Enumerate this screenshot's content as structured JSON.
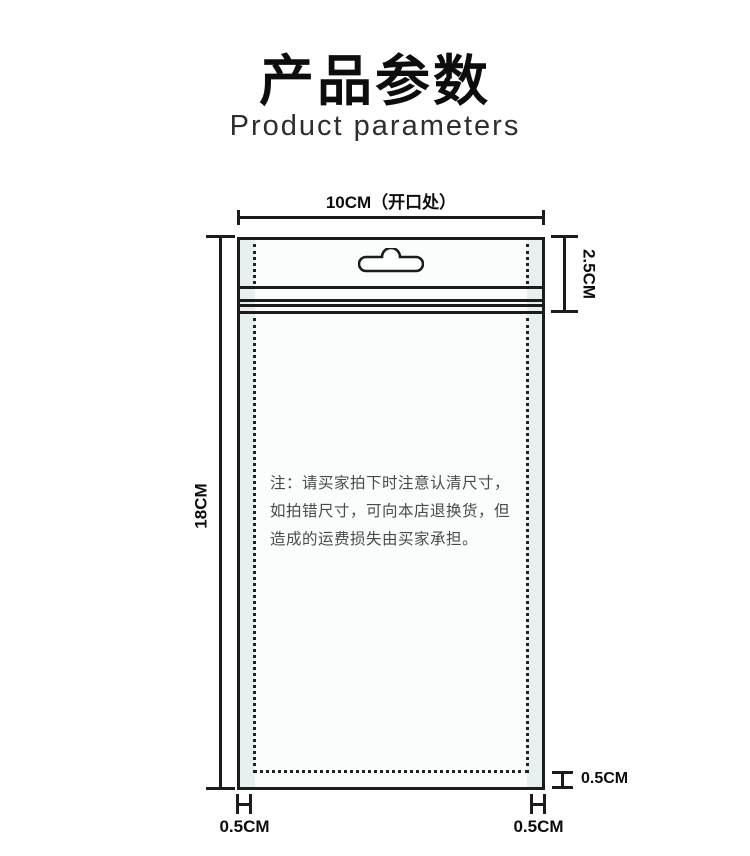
{
  "header": {
    "title": "产品参数",
    "subtitle": "Product parameters"
  },
  "colors": {
    "bag_fill": "#e7f0ee",
    "bag_inner_fill": "#fbfdfd",
    "outline": "#1c1c1c",
    "note_text": "#4a4a4a"
  },
  "diagram": {
    "dimensions": {
      "opening_width": "10CM（开口处）",
      "header_height": "2.5CM",
      "bag_height": "18CM",
      "bottom_seal": "0.5CM",
      "left_seal": "0.5CM",
      "right_seal": "0.5CM"
    },
    "note": {
      "lines": [
        "注：请买家拍下时注意认清尺寸，",
        "如拍错尺寸，可向本店退换货，但",
        "造成的运费损失由买家承担。"
      ]
    },
    "icons": {
      "hang_hole": "euro-slot-hang-hole"
    }
  }
}
